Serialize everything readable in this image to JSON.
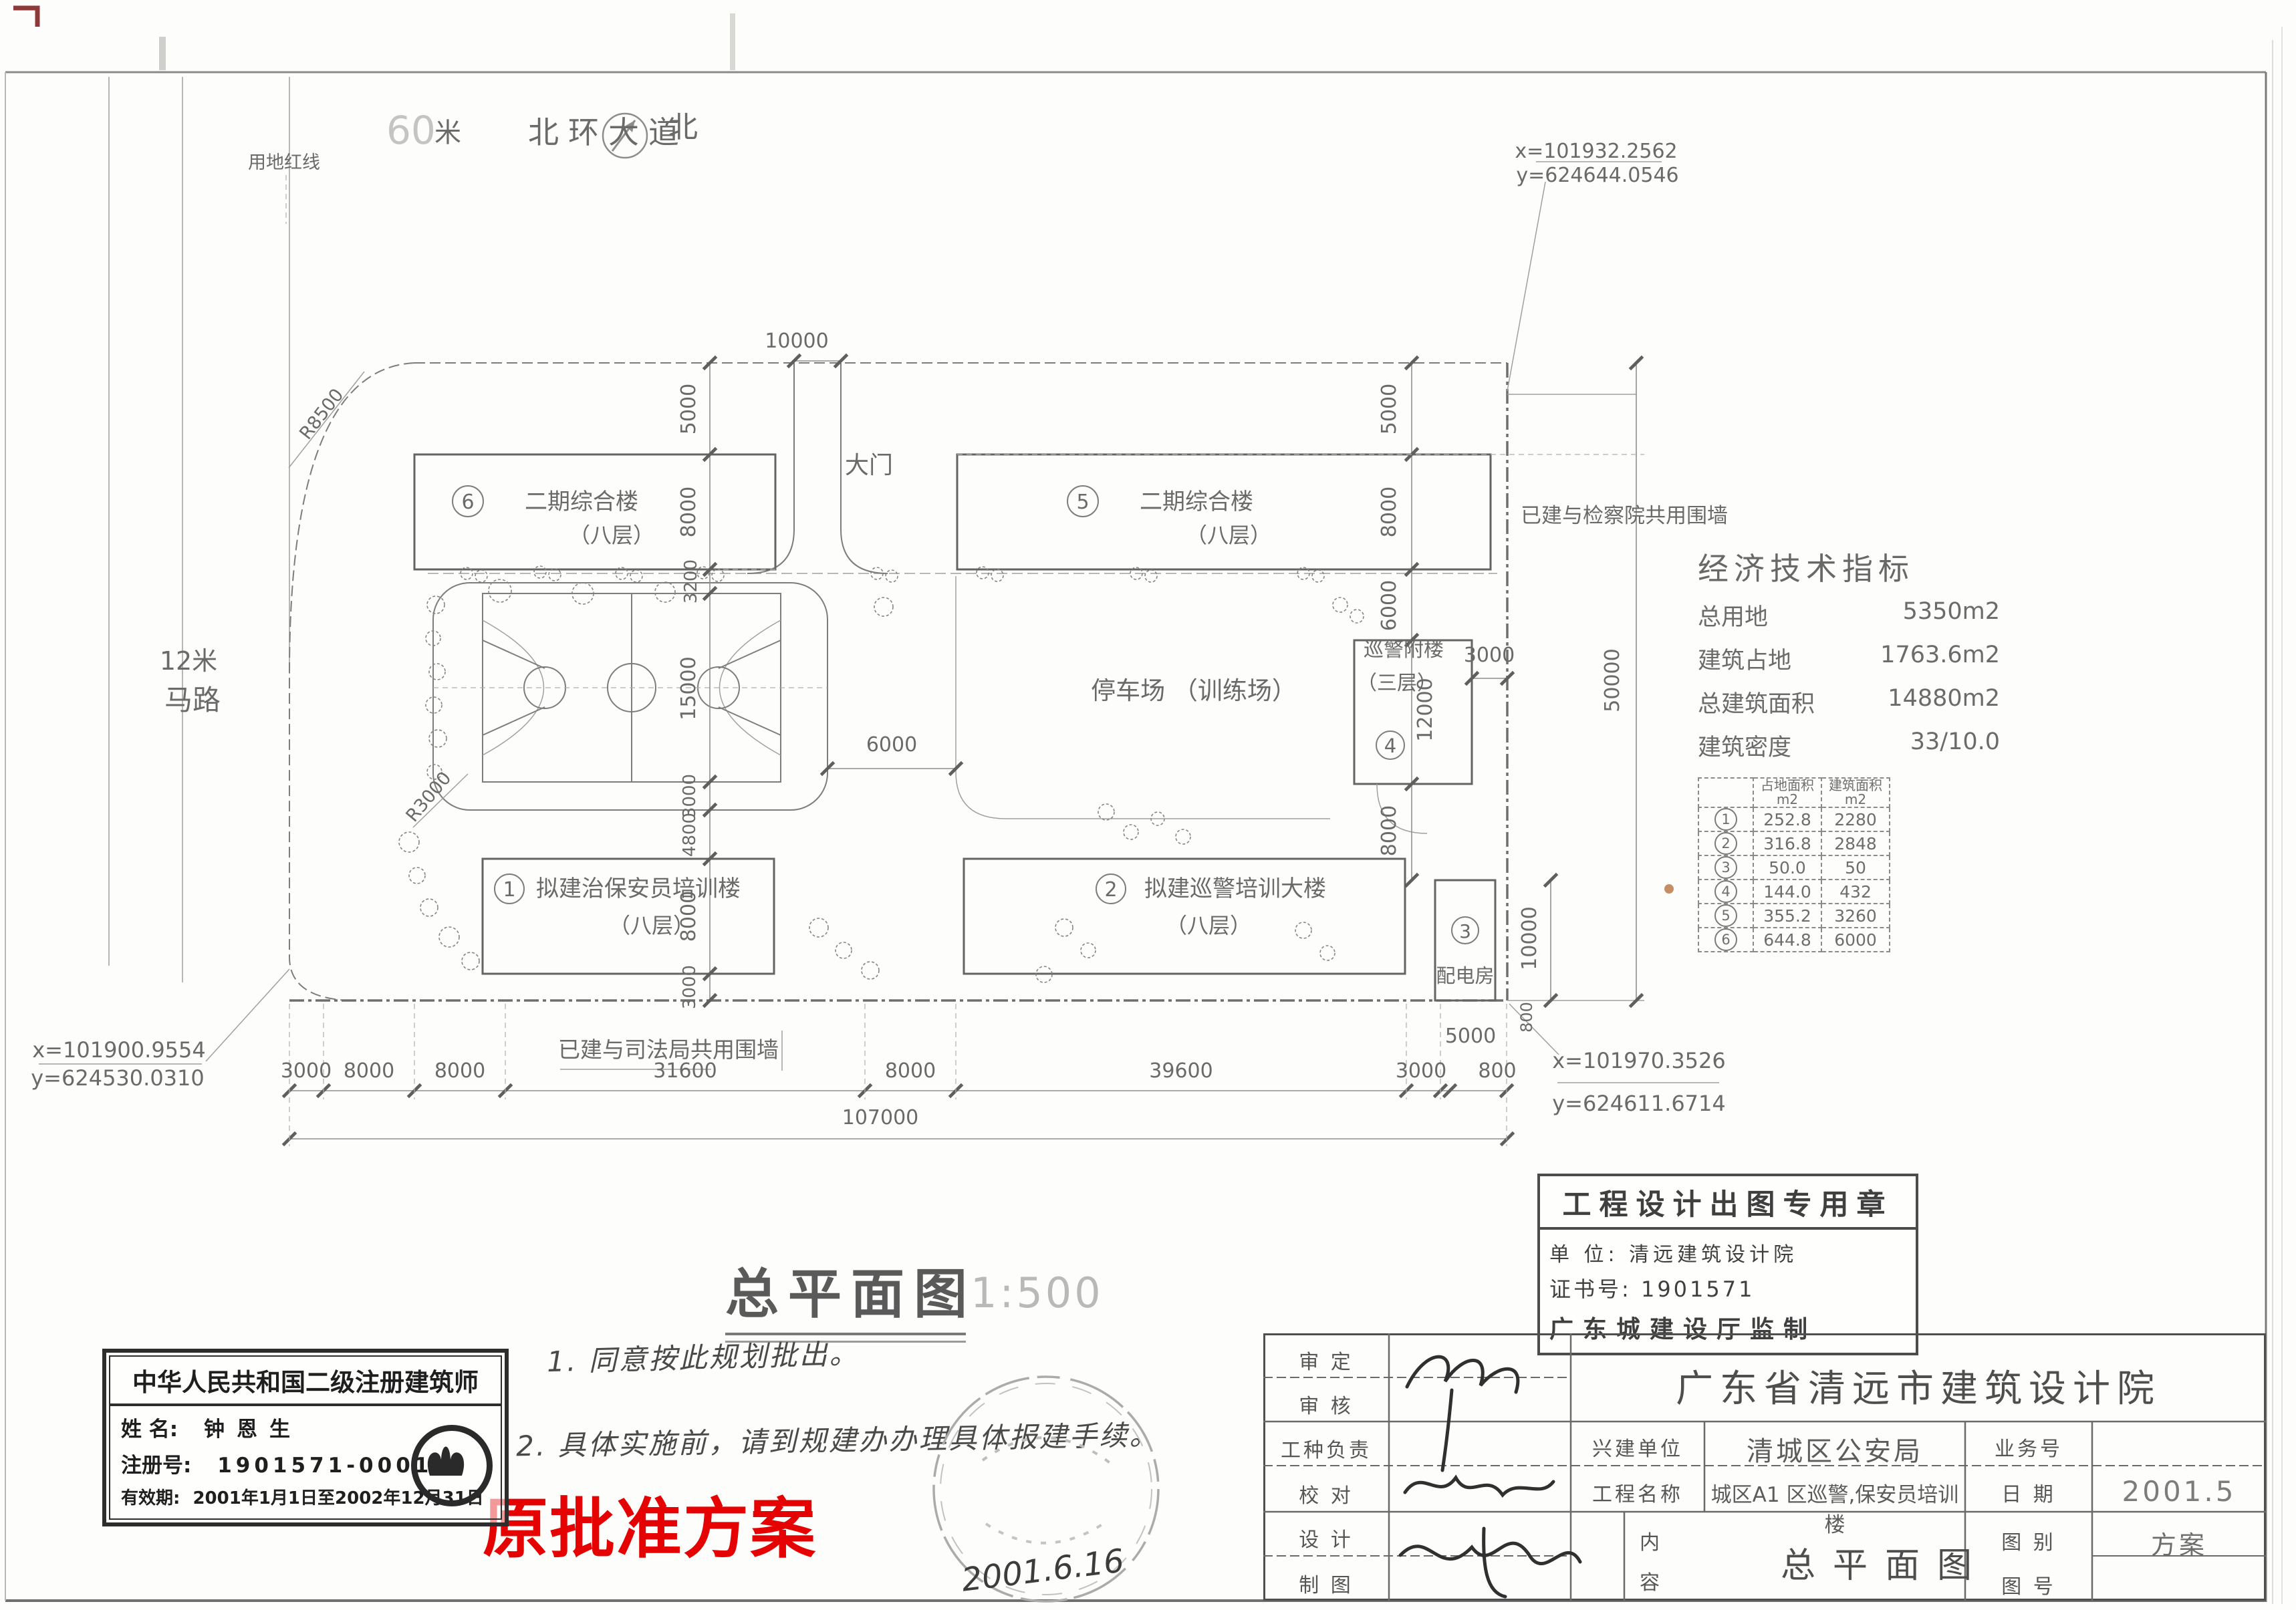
{
  "plan": {
    "north": "北",
    "road_top_num": "60",
    "road_top_unit": "米",
    "road_top_name": "北环大道",
    "road_left_width": "12米",
    "road_left_name": "马路",
    "red_line": "用地红线",
    "gate": "大门",
    "parking": "停车场 （训练场）",
    "wall_east": "已建与检察院共用围墙",
    "wall_south": "已建与司法局共用围墙",
    "r_big": "R8500",
    "r_court": "R3000",
    "coord_tr_x": "x=101932.2562",
    "coord_tr_y": "y=624644.0546",
    "coord_mr_x": "x=101970.3526",
    "coord_mr_y": "y=624611.6714",
    "coord_bl_x": "x=101900.9554",
    "coord_bl_y": "y=624530.0310"
  },
  "buildings": [
    {
      "num": "1",
      "name": "拟建治保安员培训楼",
      "floors": "（八层）"
    },
    {
      "num": "2",
      "name": "拟建巡警培训大楼",
      "floors": "（八层）"
    },
    {
      "num": "3",
      "name": "配电房",
      "floors": ""
    },
    {
      "num": "4",
      "name": "巡警附楼",
      "floors": "（三层）"
    },
    {
      "num": "5",
      "name": "二期综合楼",
      "floors": "（八层）"
    },
    {
      "num": "6",
      "name": "二期综合楼",
      "floors": "（八层）"
    }
  ],
  "dims": {
    "gate_w": "10000",
    "l1": "5000",
    "l2": "8000",
    "l3": "3200",
    "l4": "15000",
    "l5": "3000",
    "l6": "4800",
    "l7": "8000",
    "l8": "3000",
    "r1": "5000",
    "r2": "8000",
    "r3": "6000",
    "r4": "12000",
    "r5": "8000",
    "b4_side": "3000",
    "court_side": "6000",
    "b3_h": "10000",
    "wall_gap": "800",
    "east_total": "50000",
    "bc1": "3000",
    "bc2": "8000",
    "bc3": "8000",
    "bc4": "31600",
    "bc5": "8000",
    "bc6": "39600",
    "bc7": "3000",
    "bc8": "800",
    "bc9": "5000",
    "total": "107000"
  },
  "econ": {
    "title": "经济技术指标",
    "items": [
      [
        "总用地",
        "5350m2"
      ],
      [
        "建筑占地",
        "1763.6m2"
      ],
      [
        "总建筑面积",
        "14880m2"
      ],
      [
        "建筑密度",
        "33/10.0"
      ]
    ],
    "table": {
      "h1": "占地面积",
      "h2": "建筑面积",
      "unit": "m2",
      "rows": [
        [
          "1",
          "252.8",
          "2280"
        ],
        [
          "2",
          "316.8",
          "2848"
        ],
        [
          "3",
          "50.0",
          "50"
        ],
        [
          "4",
          "144.0",
          "432"
        ],
        [
          "5",
          "355.2",
          "3260"
        ],
        [
          "6",
          "644.8",
          "6000"
        ]
      ]
    }
  },
  "titlearea": {
    "name": "总平面图",
    "scale": "1:500"
  },
  "notes": {
    "n1": "1. 同意按此规划批出。",
    "n2": "2. 具体实施前，请到规建办办理具体报建手续。",
    "red": "原批准方案",
    "date": "2001.6.16"
  },
  "stampbox": {
    "title": "工程设计出图专用章",
    "unit": "单  位: 清远建筑设计院",
    "cert": "证书号: 1901571",
    "footer": "广东城建设厅监制"
  },
  "architect": {
    "title": "中华人民共和国二级注册建筑师",
    "name_l": "姓  名:",
    "name": "钟恩生",
    "reg_l": "注册号:",
    "reg": "1901571-0001",
    "valid_l": "有效期:",
    "valid": "2001年1月1日至2002年12月31日"
  },
  "titleblock": {
    "org": "广东省清远市建筑设计院",
    "r1": "审  定",
    "r2": "审  核",
    "r3": "工种负责",
    "r4": "校  对",
    "r5": "设  计",
    "r6": "制  图",
    "client_l": "兴建单位",
    "client": "清城区公安局",
    "proj_l": "工程名称",
    "proj": "城区A1 区巡警,保安员培训楼",
    "biz_l": "业务号",
    "date_l": "日  期",
    "date": "2001.5",
    "cat_l": "图  别",
    "cat": "方案",
    "no_l": "图  号",
    "content_l1": "内",
    "content_l2": "容",
    "content": "总平面图"
  }
}
